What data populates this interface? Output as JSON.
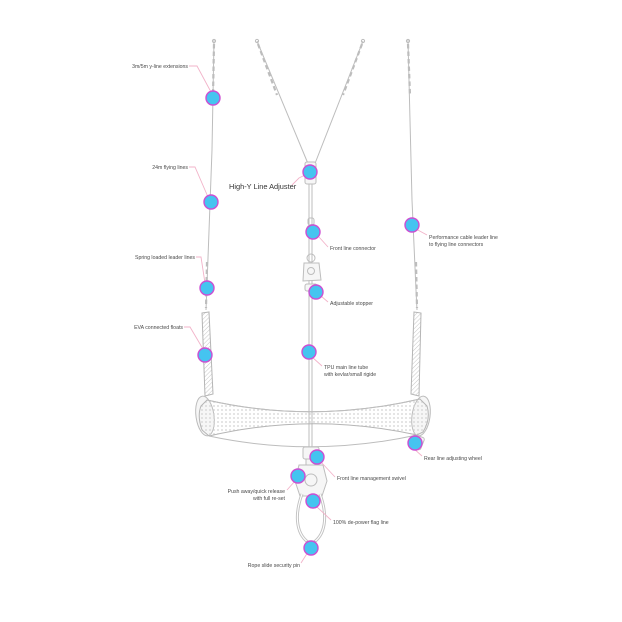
{
  "diagram": {
    "type": "kite-control-bar-callout-diagram",
    "callouts": {
      "y_line_extensions": "3m/5m y-line extensions",
      "flying_lines": "24m flying lines",
      "spring_leaders": "Spring loaded leader lines",
      "floats": "EVA connected floats",
      "high_y_adjuster": "High-Y Line Adjuster",
      "front_line_connector": "Front line connector",
      "adjustable_stopper": "Adjustable stopper",
      "main_line_tube_1": "TPU main line tube",
      "main_line_tube_2": "with kevlar/small rigide",
      "leader_lines_1": "Performance cable leader line",
      "leader_lines_2": "to flying line connectors",
      "rear_adjusting": "Rear line adjusting wheel",
      "swivel": "Front line management swivel",
      "quick_release_1": "Push away/quick release",
      "quick_release_2": "with full re-set",
      "flag_line": "100% de-power flag line",
      "security_pin": "Rope slide security pin"
    },
    "colors": {
      "dot_fill": "#45c4f0",
      "dot_ring": "#cc4ed2",
      "leader": "#f2b3c9",
      "line_art": "#bdbdbd",
      "text": "#4a4a4a"
    }
  }
}
